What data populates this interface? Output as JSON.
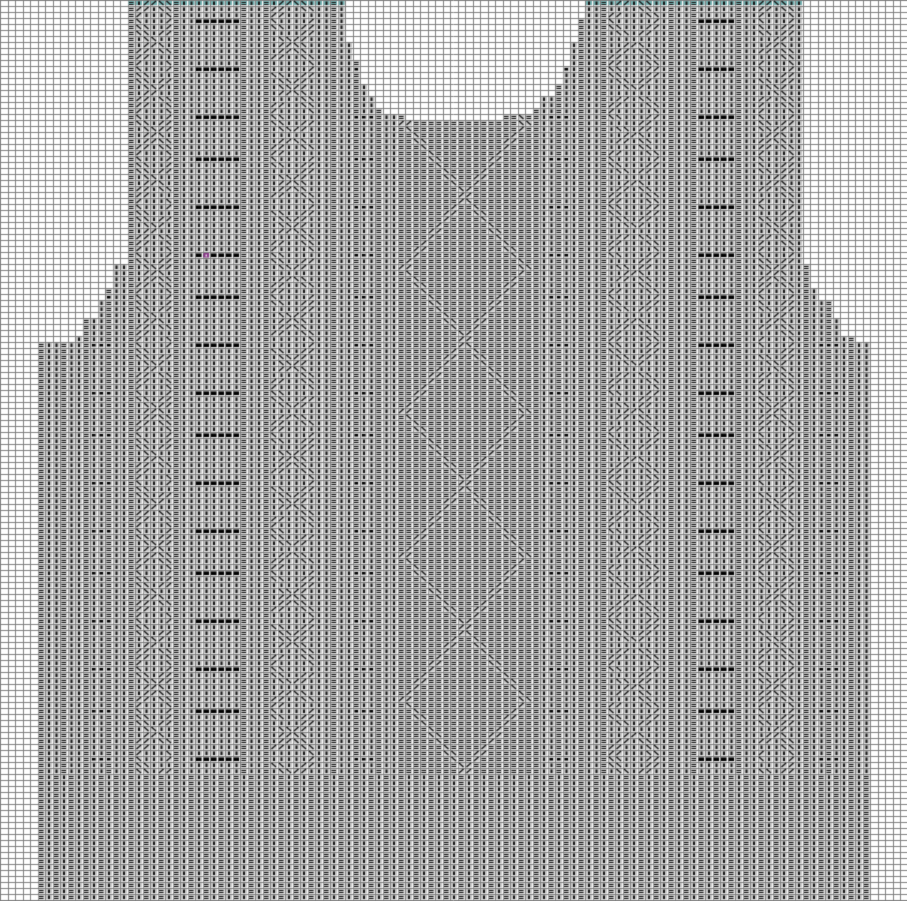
{
  "chart": {
    "kind": "knitting-stitch-chart",
    "subject": "vest-front-piece",
    "canvas": {
      "width": 907,
      "height": 901
    },
    "grid": {
      "cell_w": 7.5,
      "cell_h": 6,
      "cols": 121,
      "rows": 151
    },
    "colors": {
      "empty_bg": "#ffffff",
      "grid_line": "#7f7f7f",
      "fabric_bg": "#c6c6c6",
      "fabric_grid": "#9a9a9a",
      "symbol": "#141414",
      "motif_black": "#000000",
      "cast_off_teal": "#74b1b1",
      "marker_purple": "#8b3a8b",
      "marker_dot": "#e8d8e8"
    },
    "silhouette": {
      "body_left": 35,
      "body_right": 872,
      "body_top": 341,
      "hem_rib_top": 772,
      "strap_left": {
        "x1": 125,
        "x2": 345
      },
      "strap_right": {
        "x1": 582,
        "x2": 800
      },
      "armhole_steps": [
        {
          "y1": 265,
          "y2": 287,
          "inset": 10
        },
        {
          "y1": 287,
          "y2": 303,
          "inset": 20
        },
        {
          "y1": 303,
          "y2": 318,
          "inset": 30
        },
        {
          "y1": 318,
          "y2": 335,
          "inset": 40
        },
        {
          "y1": 335,
          "y2": 341,
          "inset": 52
        }
      ],
      "neck": {
        "x1": 345,
        "x2": 582,
        "default_depth": 121,
        "segments": [
          {
            "x1": 345,
            "x2": 353,
            "y": 44
          },
          {
            "x1": 353,
            "x2": 361,
            "y": 62
          },
          {
            "x1": 361,
            "x2": 369,
            "y": 82
          },
          {
            "x1": 369,
            "x2": 377,
            "y": 97
          },
          {
            "x1": 377,
            "x2": 385,
            "y": 106
          },
          {
            "x1": 385,
            "x2": 393,
            "y": 112
          },
          {
            "x1": 393,
            "x2": 405,
            "y": 116
          },
          {
            "x1": 405,
            "x2": 419,
            "y": 119
          },
          {
            "x1": 419,
            "x2": 506,
            "y": 121
          },
          {
            "x1": 506,
            "x2": 521,
            "y": 117
          },
          {
            "x1": 521,
            "x2": 533,
            "y": 112
          },
          {
            "x1": 533,
            "x2": 543,
            "y": 106
          },
          {
            "x1": 543,
            "x2": 553,
            "y": 97
          },
          {
            "x1": 553,
            "x2": 561,
            "y": 84
          },
          {
            "x1": 561,
            "x2": 569,
            "y": 66
          },
          {
            "x1": 569,
            "x2": 575,
            "y": 44
          },
          {
            "x1": 575,
            "x2": 582,
            "y": 18
          }
        ]
      }
    },
    "texture": {
      "base_repeat": [
        "bar",
        "bar",
        "dash"
      ],
      "rib_repeat": [
        "bar",
        "dash"
      ]
    },
    "motif_rows": {
      "phase": 20,
      "period": 46,
      "thickness": 6,
      "stop_y": 766
    },
    "bands": [
      {
        "type": "dots",
        "x1": 88,
        "x2": 110
      },
      {
        "type": "braid",
        "x1": 135,
        "x2": 175
      },
      {
        "type": "wide",
        "x1": 196,
        "x2": 237
      },
      {
        "type": "braid",
        "x1": 272,
        "x2": 314
      },
      {
        "type": "dots",
        "x1": 352,
        "x2": 374
      },
      {
        "type": "dots",
        "x1": 546,
        "x2": 568
      },
      {
        "type": "braid",
        "x1": 610,
        "x2": 657
      },
      {
        "type": "wide",
        "x1": 697,
        "x2": 737
      },
      {
        "type": "braid",
        "x1": 755,
        "x2": 795
      },
      {
        "type": "dots",
        "x1": 816,
        "x2": 838
      }
    ],
    "center_panel": {
      "x1": 398,
      "x2": 532,
      "cx": 465,
      "crossing_start": 195,
      "crossing_period": 144,
      "half_height": 72,
      "slope": 0.83,
      "line_tol": 4
    },
    "cast_off_strip": {
      "height": 4
    },
    "marker_cell": {
      "x": 206,
      "y": 255
    }
  }
}
